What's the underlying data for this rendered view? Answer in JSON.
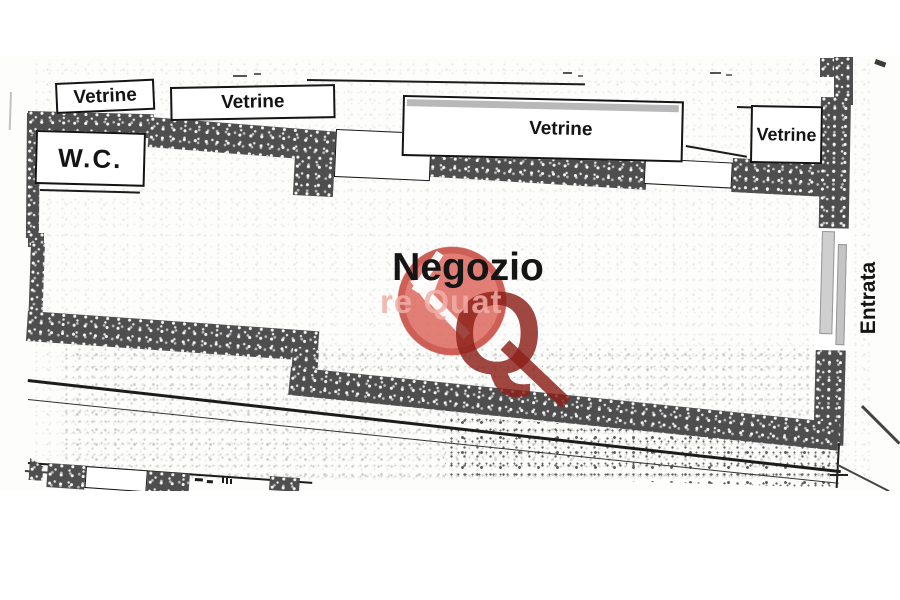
{
  "plan": {
    "labels": {
      "negozio": "Negozio",
      "wc": "W.C.",
      "entrata": "Entrata"
    },
    "vetrine": [
      "Vetrine",
      "Vetrine",
      "Vetrine",
      "Vetrine"
    ],
    "watermark": {
      "letter": "Q",
      "text_fragment": "re Quat",
      "circle_color": "#d85b50",
      "ring_color": "#bf453c",
      "letter_color": "#8c2019",
      "text_color": "#f1aea6",
      "arrow_color": "#ffffff"
    },
    "colors": {
      "wall": "#4e4e4e",
      "line": "#1c1c1c",
      "background": "#fdfdfc"
    }
  }
}
